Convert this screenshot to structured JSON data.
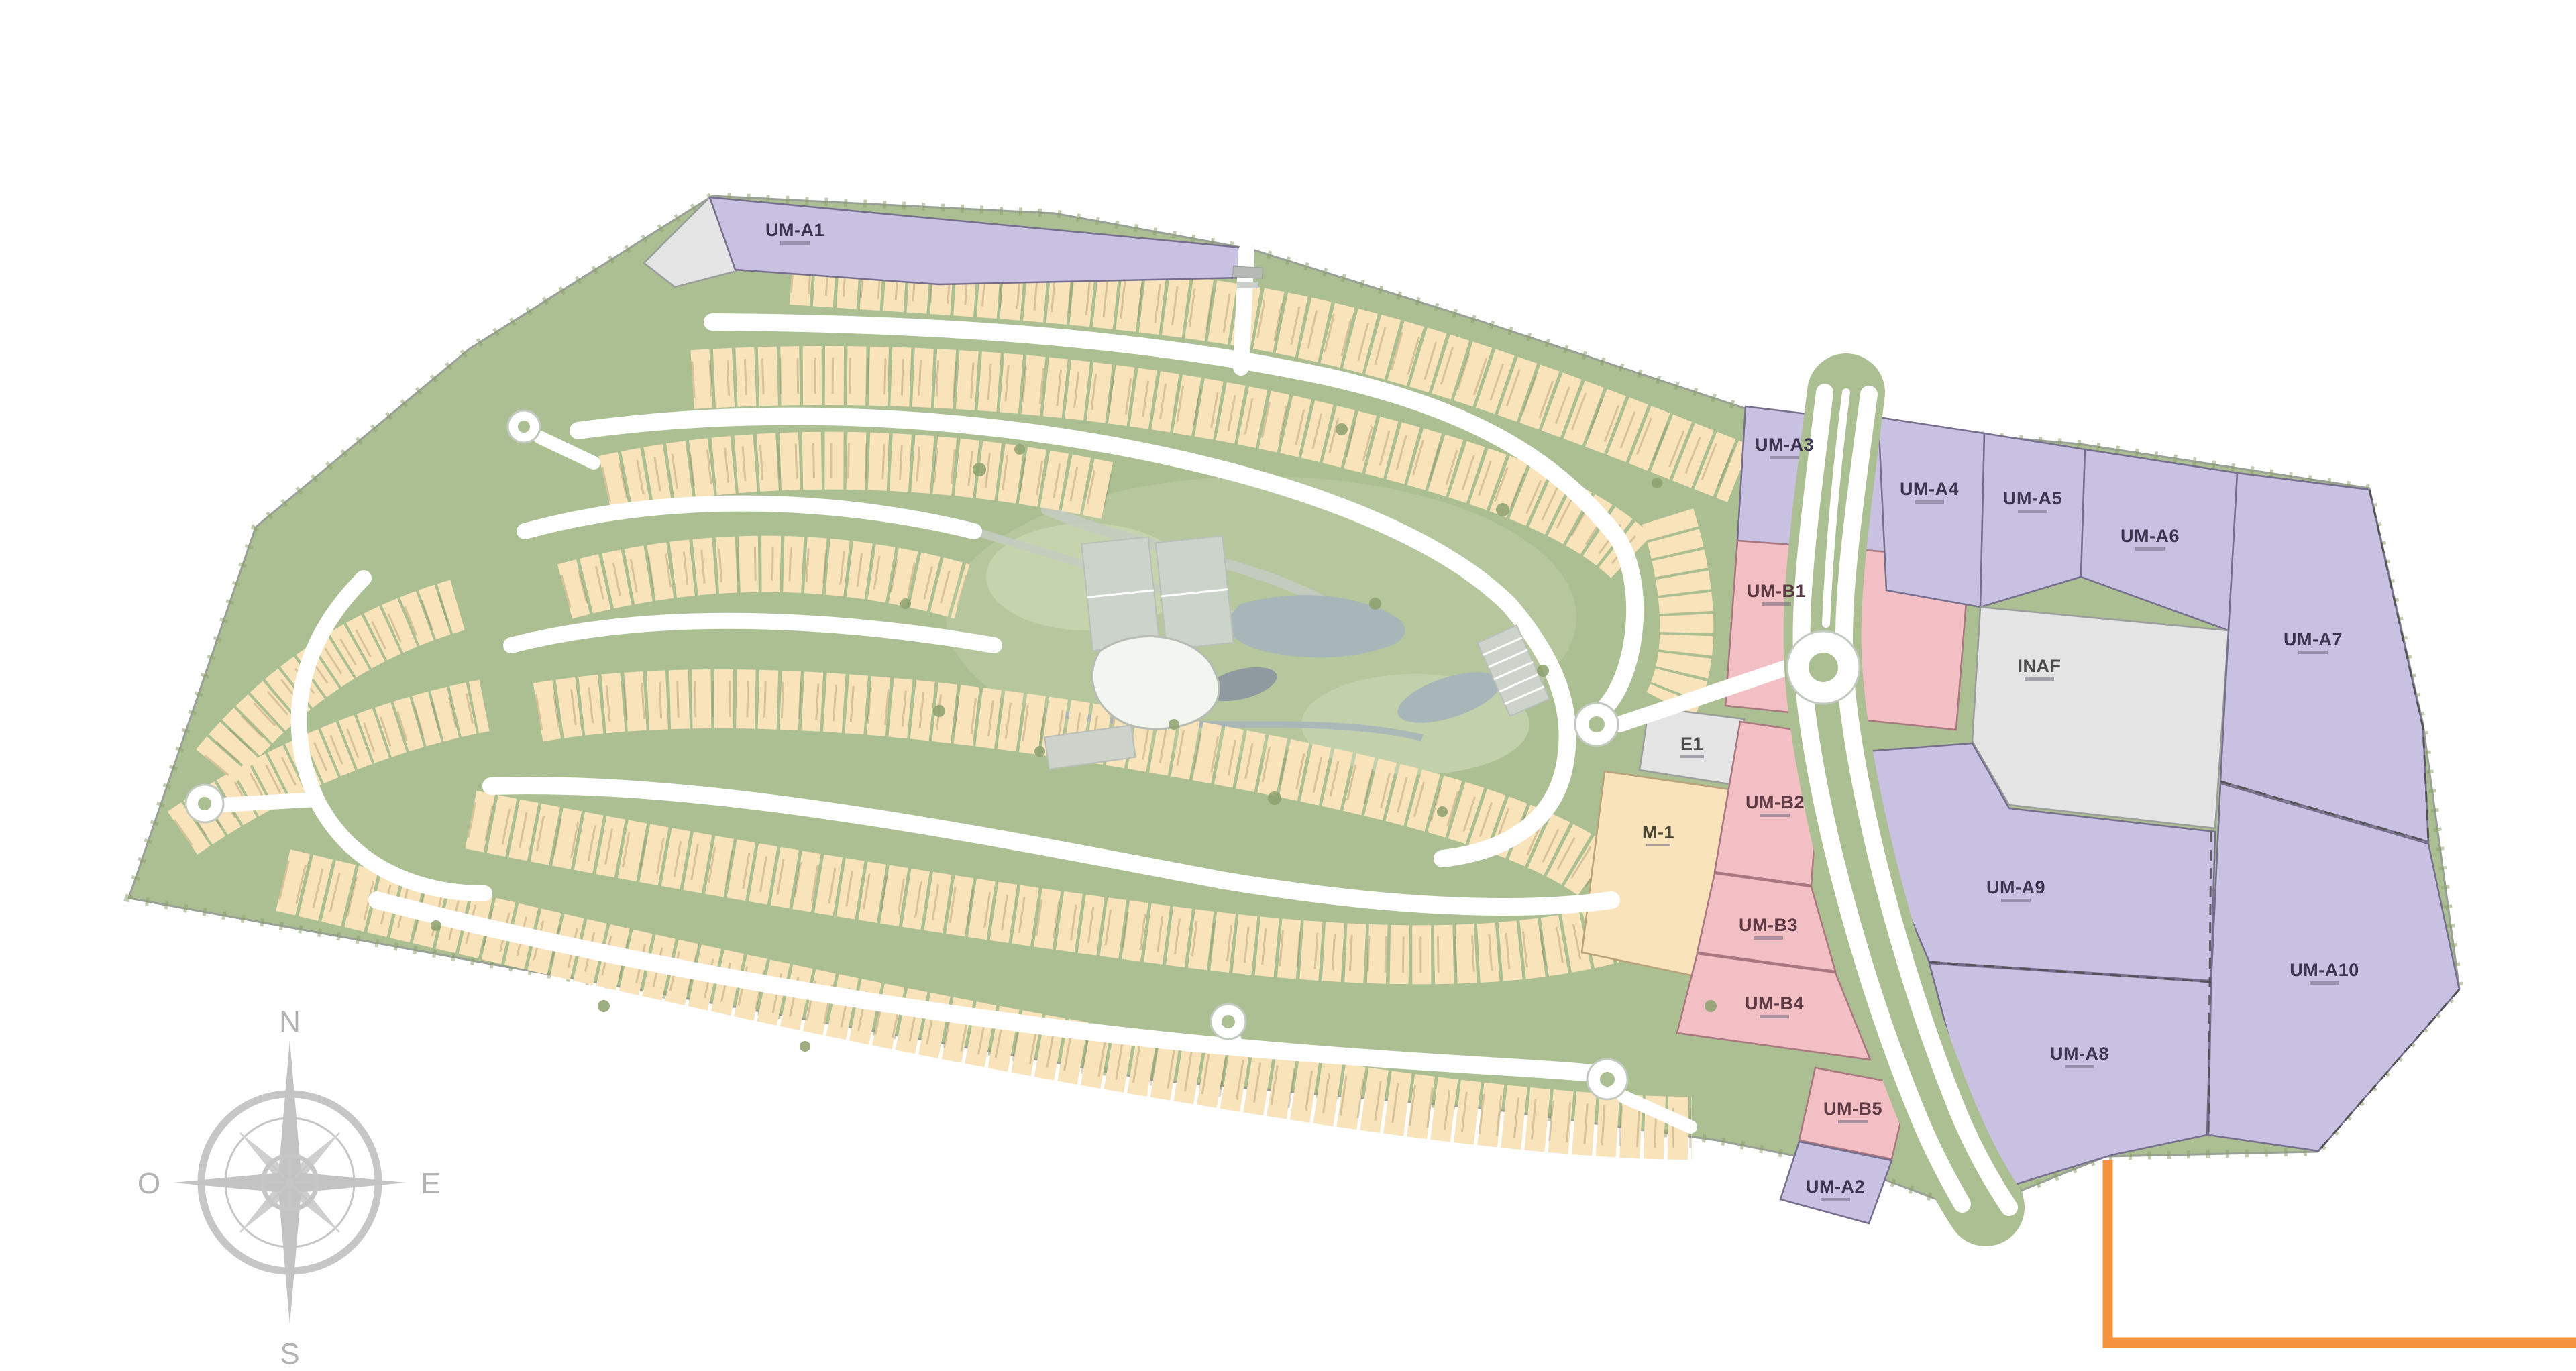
{
  "compass": {
    "north": "N",
    "east": "E",
    "south": "S",
    "west": "O"
  },
  "parcels": [
    {
      "label": "UM-A1",
      "zone": "purple"
    },
    {
      "label": "UM-A3",
      "zone": "purple"
    },
    {
      "label": "UM-B1",
      "zone": "pink"
    },
    {
      "label": "E1",
      "zone": "gray"
    },
    {
      "label": "M-1",
      "zone": "tan"
    },
    {
      "label": "UM-B2",
      "zone": "pink"
    },
    {
      "label": "UM-B3",
      "zone": "pink"
    },
    {
      "label": "UM-B4",
      "zone": "pink"
    },
    {
      "label": "UM-B5",
      "zone": "pink"
    },
    {
      "label": "UM-A2",
      "zone": "purple"
    },
    {
      "label": "UM-A4",
      "zone": "purple"
    },
    {
      "label": "UM-A5",
      "zone": "purple"
    },
    {
      "label": "UM-A6",
      "zone": "purple"
    },
    {
      "label": "UM-A7",
      "zone": "purple"
    },
    {
      "label": "INAF",
      "zone": "gray"
    },
    {
      "label": "UM-A9",
      "zone": "purple"
    },
    {
      "label": "UM-A10",
      "zone": "purple"
    },
    {
      "label": "UM-A8",
      "zone": "purple"
    }
  ],
  "colors": {
    "residential": "#f8e3ba",
    "parcel_purple": "#c9c1e1",
    "parcel_pink": "#f2bfc5",
    "parcel_gray": "#e3e4e3",
    "green": "#abbf92",
    "green_dark": "#8ca06d",
    "road": "#ffffff",
    "water": "#a7b6b8",
    "boundary_orange": "#f5923e",
    "compass_gray": "#c6c6c6"
  }
}
